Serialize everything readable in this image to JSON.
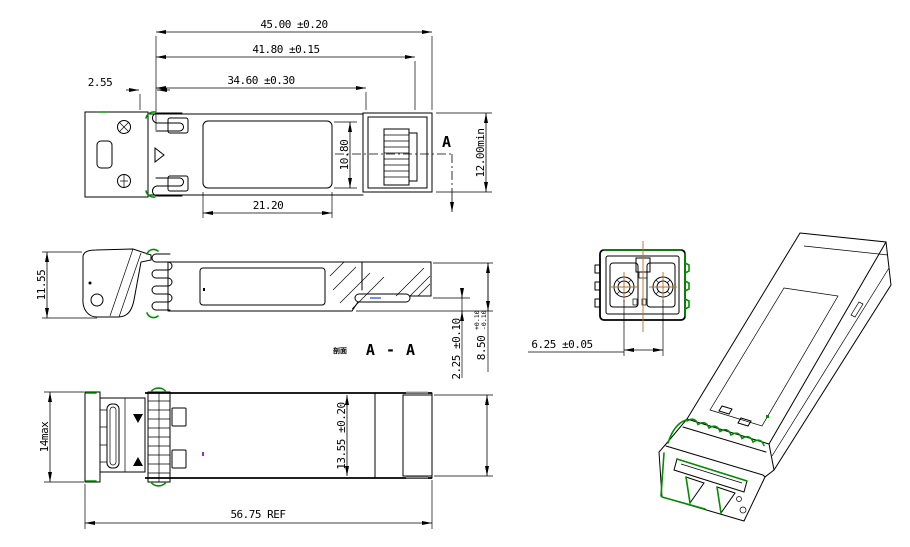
{
  "drawing_type": "SFP optical transceiver mechanical outline drawing",
  "colors": {
    "line": "#000000",
    "accent_green": "#008f00",
    "centerline_orange": "#b4722c",
    "background": "#ffffff"
  },
  "views": {
    "top": {
      "dims": {
        "overall_length": "45.00 ±0.20",
        "latch_length": "41.80 ±0.15",
        "body_length": "34.60 ±0.30",
        "front_offset": "2.55",
        "label_length": "21.20",
        "label_width": "10.80",
        "port_clearance": "12.00min",
        "section_marker": "A"
      }
    },
    "side": {
      "dims": {
        "bail_height": "11.55",
        "step_height": "2.25 ±0.10",
        "body_height": "8.50",
        "body_height_tol_upper": "+0.10",
        "body_height_tol_lower": "-0.10"
      },
      "section_label_prefix": "剖面",
      "section_label": "A - A"
    },
    "bottom": {
      "dims": {
        "front_width_max": "14max",
        "body_width": "13.55 ±0.20",
        "rear_width_max": "13.4 max",
        "overall_length_ref": "56.75 REF"
      }
    },
    "front": {
      "dims": {
        "fiber_pitch": "6.25 ±0.05"
      }
    }
  }
}
